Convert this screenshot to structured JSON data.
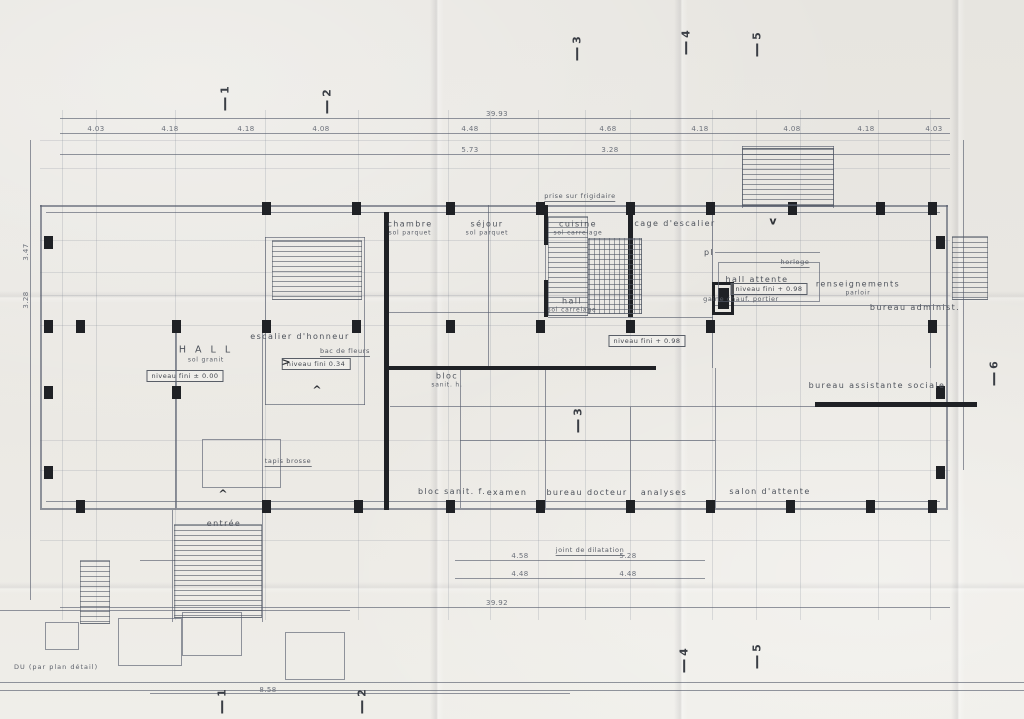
{
  "plan": {
    "note": "DU  (par plan détail)",
    "colors": {
      "paper": "#e9e7e2",
      "line": "#5a6170",
      "faint_grid": "#7d8491",
      "dark_wall": "#1f2125",
      "text": "#4d525b"
    },
    "rooms": [
      {
        "text": "H A L L",
        "sub": "sol granit",
        "x": 206,
        "y": 354,
        "big": true
      },
      {
        "text": "escalier d'honneur",
        "x": 300,
        "y": 337
      },
      {
        "text": "chambre",
        "sub": "sol parquet",
        "x": 410,
        "y": 228
      },
      {
        "text": "séjour",
        "sub": "sol parquet",
        "x": 487,
        "y": 228
      },
      {
        "text": "cuisine",
        "sub": "sol carrelage",
        "x": 578,
        "y": 228
      },
      {
        "text": "hall",
        "sub": "sol carrelage",
        "x": 572,
        "y": 305
      },
      {
        "text": "cage d'escalier",
        "x": 675,
        "y": 224
      },
      {
        "text": "pl",
        "x": 709,
        "y": 253
      },
      {
        "text": "hall  attente",
        "x": 757,
        "y": 280
      },
      {
        "text": "renseignements",
        "sub": "parloir",
        "x": 858,
        "y": 288
      },
      {
        "text": "bureau administ.",
        "x": 915,
        "y": 308
      },
      {
        "text": "bureau assistante sociale",
        "x": 877,
        "y": 386
      },
      {
        "text": "salon  d'attente",
        "x": 770,
        "y": 492
      },
      {
        "text": "analyses",
        "x": 664,
        "y": 493
      },
      {
        "text": "bureau  docteur",
        "x": 587,
        "y": 493
      },
      {
        "text": "examen",
        "x": 507,
        "y": 493
      },
      {
        "text": "bloc",
        "sub": "sanit. h.",
        "x": 447,
        "y": 380
      },
      {
        "text": "bloc sanit. f.",
        "x": 452,
        "y": 492
      },
      {
        "text": "entrée",
        "x": 224,
        "y": 524
      }
    ],
    "levels": [
      {
        "text": "niveau fini ± 0.00",
        "x": 185,
        "y": 376
      },
      {
        "text": "niveau fini   0.34",
        "x": 316,
        "y": 364
      },
      {
        "text": "niveau fini + 0.98",
        "x": 769,
        "y": 289
      },
      {
        "text": "niveau fini + 0.98",
        "x": 647,
        "y": 341
      }
    ],
    "annotations": [
      {
        "text": "bac de fleurs",
        "x": 345,
        "y": 352,
        "underline": true
      },
      {
        "text": "prise sur frigidaire",
        "x": 580,
        "y": 197,
        "underline": true
      },
      {
        "text": "horloge",
        "x": 795,
        "y": 263,
        "underline": true
      },
      {
        "text": "gaine chauf. portier",
        "x": 741,
        "y": 299,
        "underline": false
      },
      {
        "text": "tapis brosse",
        "x": 288,
        "y": 462,
        "underline": true
      },
      {
        "text": "joint de dilatation",
        "x": 590,
        "y": 551,
        "underline": true
      }
    ],
    "dims": [
      {
        "t": "39.93",
        "x": 497,
        "y": 114
      },
      {
        "t": "4.03",
        "x": 96,
        "y": 129
      },
      {
        "t": "4.18",
        "x": 170,
        "y": 129
      },
      {
        "t": "4.18",
        "x": 246,
        "y": 129
      },
      {
        "t": "4.08",
        "x": 321,
        "y": 129
      },
      {
        "t": "4.48",
        "x": 470,
        "y": 129
      },
      {
        "t": "4.68",
        "x": 608,
        "y": 129
      },
      {
        "t": "4.18",
        "x": 700,
        "y": 129
      },
      {
        "t": "4.08",
        "x": 792,
        "y": 129
      },
      {
        "t": "4.18",
        "x": 866,
        "y": 129
      },
      {
        "t": "4.03",
        "x": 934,
        "y": 129
      },
      {
        "t": "5.73",
        "x": 470,
        "y": 150
      },
      {
        "t": "3.28",
        "x": 610,
        "y": 150
      },
      {
        "t": "4.58",
        "x": 520,
        "y": 556
      },
      {
        "t": "5.28",
        "x": 628,
        "y": 556
      },
      {
        "t": "4.48",
        "x": 520,
        "y": 574
      },
      {
        "t": "4.48",
        "x": 628,
        "y": 574
      },
      {
        "t": "39.92",
        "x": 497,
        "y": 603
      },
      {
        "t": "8.58",
        "x": 268,
        "y": 690
      },
      {
        "t": "3.47",
        "x": 26,
        "y": 252,
        "rot": true
      },
      {
        "t": "3.28",
        "x": 26,
        "y": 300,
        "rot": true
      }
    ],
    "markers": [
      {
        "n": "1",
        "x": 225,
        "y": 97
      },
      {
        "n": "2",
        "x": 327,
        "y": 100
      },
      {
        "n": "3",
        "x": 577,
        "y": 47
      },
      {
        "n": "4",
        "x": 686,
        "y": 41
      },
      {
        "n": "5",
        "x": 757,
        "y": 43
      },
      {
        "n": "6",
        "x": 994,
        "y": 372
      },
      {
        "n": "3",
        "x": 578,
        "y": 419
      },
      {
        "n": "4",
        "x": 684,
        "y": 659
      },
      {
        "n": "5",
        "x": 757,
        "y": 655
      },
      {
        "n": "1",
        "x": 222,
        "y": 700
      },
      {
        "n": "2",
        "x": 362,
        "y": 700
      }
    ],
    "glyphs": [
      {
        "g": ">",
        "x": 286,
        "y": 362
      },
      {
        "g": "^",
        "x": 317,
        "y": 390
      },
      {
        "g": "^",
        "x": 223,
        "y": 494
      },
      {
        "g": "v",
        "x": 773,
        "y": 221
      }
    ],
    "grid": {
      "v": [
        62,
        96,
        175,
        265,
        358,
        448,
        490,
        538,
        585,
        630,
        712,
        756,
        800,
        878,
        930
      ],
      "h": [
        140,
        168,
        240,
        272,
        295,
        325,
        440,
        470,
        540
      ],
      "vspan": [
        110,
        620
      ],
      "hspan": [
        40,
        950
      ]
    },
    "lines": [
      [
        60,
        118,
        890,
        1
      ],
      [
        60,
        133,
        890,
        1
      ],
      [
        60,
        154,
        890,
        1
      ],
      [
        455,
        560,
        250,
        1
      ],
      [
        455,
        578,
        250,
        1
      ],
      [
        60,
        607,
        890,
        1
      ],
      [
        150,
        693,
        420,
        1
      ],
      [
        0,
        682,
        1024,
        1
      ],
      [
        0,
        690,
        1024,
        1
      ],
      [
        30,
        140,
        1,
        460
      ],
      [
        963,
        140,
        1,
        330
      ],
      [
        40,
        205,
        908,
        2
      ],
      [
        40,
        508,
        908,
        2
      ],
      [
        40,
        205,
        2,
        303
      ],
      [
        946,
        205,
        2,
        303
      ],
      [
        46,
        212,
        894,
        1
      ],
      [
        46,
        501,
        894,
        1
      ],
      [
        488,
        205,
        1,
        163
      ],
      [
        712,
        205,
        1,
        163
      ],
      [
        930,
        205,
        1,
        163
      ],
      [
        460,
        368,
        1,
        140
      ],
      [
        545,
        368,
        1,
        140
      ],
      [
        630,
        407,
        1,
        101
      ],
      [
        715,
        368,
        1,
        140
      ],
      [
        545,
        205,
        1,
        112
      ],
      [
        175,
        325,
        2,
        183
      ],
      [
        262,
        325,
        1,
        183
      ],
      [
        385,
        312,
        160,
        1
      ],
      [
        548,
        317,
        165,
        1
      ],
      [
        460,
        440,
        255,
        1
      ],
      [
        715,
        252,
        105,
        1
      ],
      [
        715,
        305,
        232,
        1
      ],
      [
        390,
        406,
        558,
        1
      ],
      [
        172,
        510,
        1,
        112
      ],
      [
        262,
        510,
        1,
        112
      ],
      [
        140,
        560,
        35,
        1
      ],
      [
        0,
        610,
        350,
        1
      ],
      [
        742,
        146,
        92,
        1
      ],
      [
        742,
        206,
        92,
        1
      ],
      [
        742,
        146,
        1,
        62
      ],
      [
        833,
        146,
        1,
        62
      ],
      [
        265,
        237,
        100,
        1
      ],
      [
        265,
        404,
        100,
        1
      ],
      [
        265,
        237,
        1,
        168
      ],
      [
        364,
        237,
        1,
        168
      ]
    ],
    "dark_walls": [
      [
        384,
        212,
        5,
        298
      ],
      [
        628,
        205,
        5,
        112
      ],
      [
        384,
        366,
        272,
        4
      ],
      [
        815,
        402,
        162,
        5
      ],
      [
        712,
        282,
        22,
        3
      ],
      [
        712,
        312,
        22,
        3
      ],
      [
        712,
        282,
        3,
        33
      ],
      [
        731,
        282,
        3,
        33
      ],
      [
        718,
        288,
        11,
        21
      ],
      [
        544,
        205,
        4,
        40
      ],
      [
        544,
        280,
        4,
        37
      ]
    ],
    "boxes": [
      [
        202,
        439,
        77,
        47
      ],
      [
        718,
        262,
        100,
        38
      ],
      [
        45,
        622,
        32,
        26
      ],
      [
        118,
        618,
        62,
        46
      ],
      [
        182,
        612,
        58,
        42
      ],
      [
        285,
        632,
        58,
        46
      ]
    ],
    "columns": [
      [
        262,
        202
      ],
      [
        352,
        202
      ],
      [
        446,
        202
      ],
      [
        536,
        202
      ],
      [
        626,
        202
      ],
      [
        706,
        202
      ],
      [
        788,
        202
      ],
      [
        876,
        202
      ],
      [
        928,
        202
      ],
      [
        44,
        320
      ],
      [
        76,
        320
      ],
      [
        172,
        320
      ],
      [
        262,
        320
      ],
      [
        352,
        320
      ],
      [
        446,
        320
      ],
      [
        536,
        320
      ],
      [
        626,
        320
      ],
      [
        706,
        320
      ],
      [
        928,
        320
      ],
      [
        44,
        386
      ],
      [
        172,
        386
      ],
      [
        936,
        386
      ],
      [
        76,
        500
      ],
      [
        262,
        500
      ],
      [
        354,
        500
      ],
      [
        446,
        500
      ],
      [
        536,
        500
      ],
      [
        626,
        500
      ],
      [
        706,
        500
      ],
      [
        786,
        500
      ],
      [
        866,
        500
      ],
      [
        928,
        500
      ],
      [
        44,
        236
      ],
      [
        44,
        466
      ],
      [
        936,
        236
      ],
      [
        936,
        466
      ]
    ],
    "stairs": [
      {
        "x": 272,
        "y": 240,
        "w": 88,
        "h": 58,
        "dir": "h"
      },
      {
        "x": 548,
        "y": 216,
        "w": 38,
        "h": 98,
        "dir": "h"
      },
      {
        "x": 588,
        "y": 238,
        "w": 52,
        "h": 74,
        "dir": "x"
      },
      {
        "x": 742,
        "y": 148,
        "w": 90,
        "h": 56,
        "dir": "h"
      },
      {
        "x": 174,
        "y": 524,
        "w": 86,
        "h": 92,
        "dir": "h"
      },
      {
        "x": 80,
        "y": 560,
        "w": 28,
        "h": 62,
        "dir": "h"
      },
      {
        "x": 952,
        "y": 236,
        "w": 34,
        "h": 62,
        "dir": "h"
      }
    ],
    "creases": {
      "vertical": [
        437,
        681,
        958
      ],
      "horizontal": [
        297,
        588
      ]
    }
  }
}
